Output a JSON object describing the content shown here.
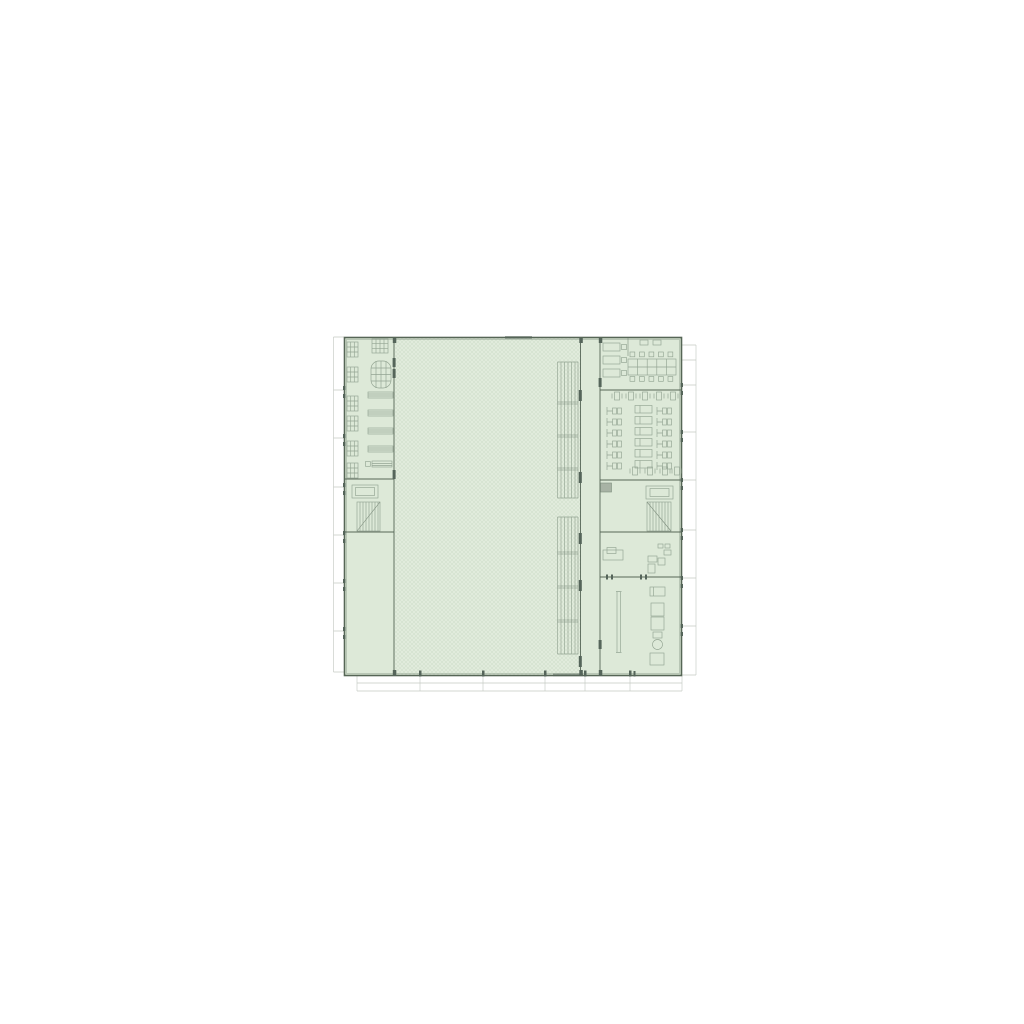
{
  "page": {
    "background": "#ffffff"
  },
  "drawing": {
    "kind": "building floor plan",
    "colors": {
      "background": "#ffffff",
      "floor_fill": "#dde9d8",
      "hall_fill": "#e1ebdc",
      "hatch_line": "#cddcc8",
      "wall": "#566656",
      "wall_light": "#7e8e7e",
      "furniture_line": "#93a492",
      "faint_line": "#c5cac4",
      "dark_accent": "#55655a",
      "shaft_fill": "#a8b3a5"
    },
    "features": {
      "stair_cores": 2,
      "elevators": 2,
      "bleacher_banks": 2,
      "fitness_equipment_rows": 6,
      "lounge_tables": 5,
      "lounge_seat_groups": 8,
      "office_desks": 3,
      "shared_desk_seats": 10
    }
  }
}
